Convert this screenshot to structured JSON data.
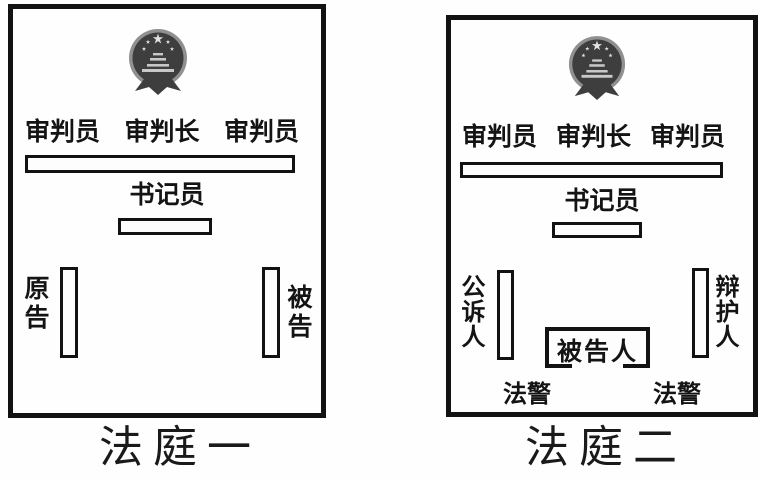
{
  "diagram": {
    "emblem": "china-national-emblem",
    "colors": {
      "line": "#121212",
      "background": "#fefefe",
      "emblem_ring": "#909090",
      "emblem_disc": "#3e3e3e",
      "emblem_stars": "#e2e2e2",
      "emblem_gate": "#c8c8c8"
    },
    "courtroom1": {
      "caption": "法庭一",
      "judges": [
        "审判员",
        "审判长",
        "审判员"
      ],
      "clerk": "书记员",
      "plaintiff": "原告",
      "defendant": "被告"
    },
    "courtroom2": {
      "caption": "法庭二",
      "judges": [
        "审判员",
        "审判长",
        "审判员"
      ],
      "clerk": "书记员",
      "prosecutor": "公诉人",
      "defender": "辩护人",
      "dock": "被告人",
      "bailiff_left": "法警",
      "bailiff_right": "法警"
    }
  }
}
